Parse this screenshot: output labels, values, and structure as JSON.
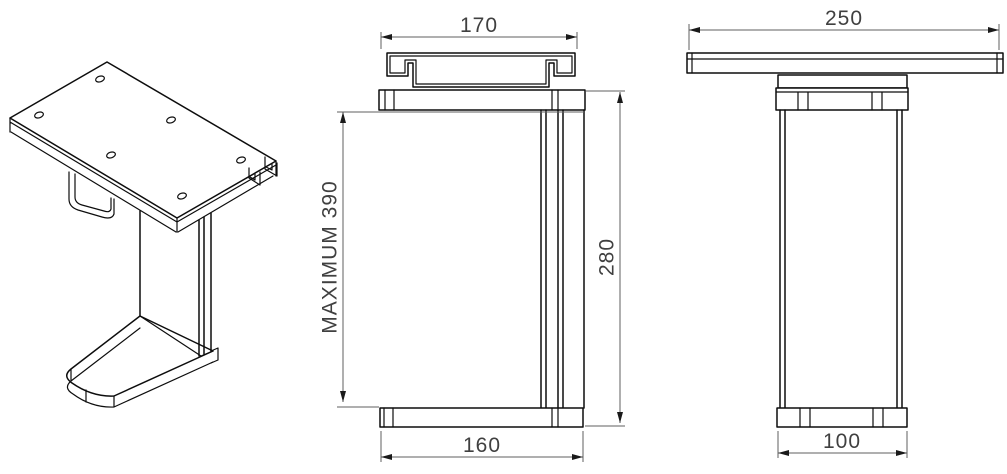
{
  "drawing": {
    "type": "technical-orthographic-drawing",
    "views": {
      "isometric": "isometric-view",
      "front": "front-view",
      "side": "side-view"
    },
    "dimensions": {
      "front_view": {
        "top_width": "170",
        "max_height": "MAXIMUM 390",
        "base_width": "160",
        "overall_height": "280"
      },
      "side_view": {
        "top_width": "250",
        "base_width": "100"
      }
    },
    "colors": {
      "background": "#ffffff",
      "object_line": "#0d0d0d",
      "dimension_line": "#5f5f5f",
      "dimension_text": "#404040",
      "arrowhead": "#1a1a1a"
    }
  }
}
